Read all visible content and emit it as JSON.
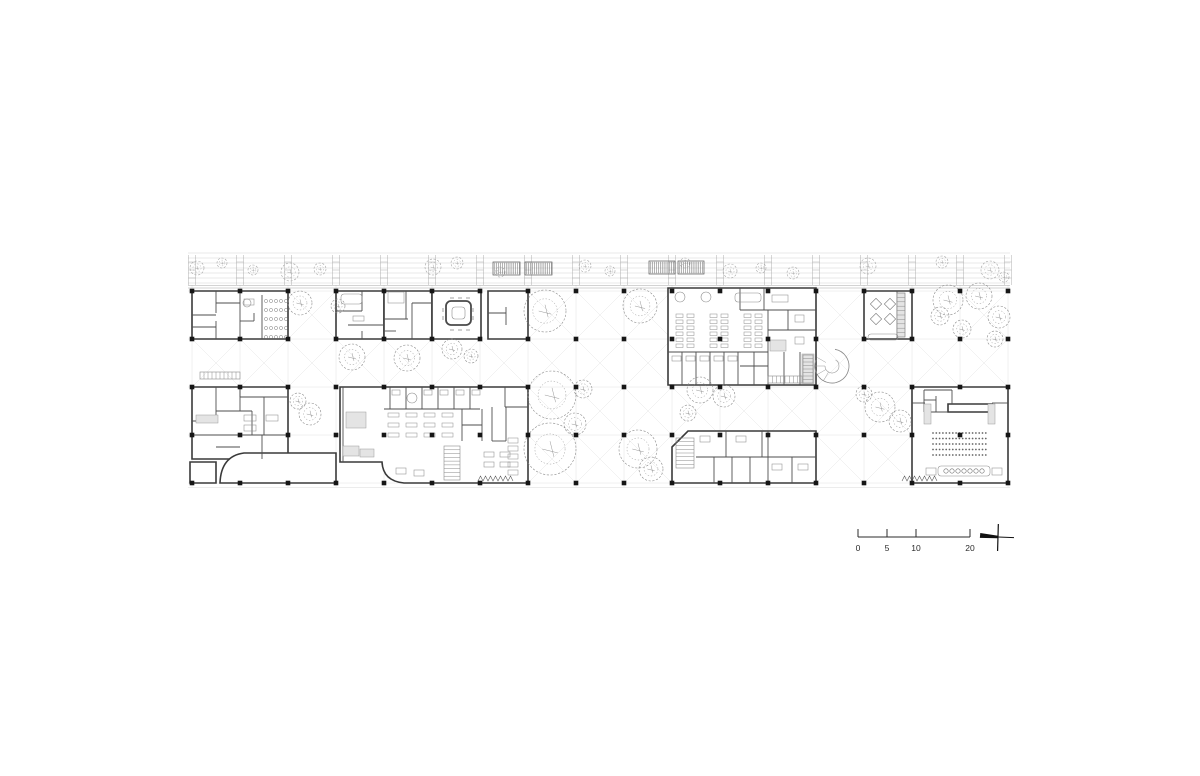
{
  "page": {
    "background": "#ffffff",
    "width": 1200,
    "height": 776,
    "title": "ground floor plan"
  },
  "colors": {
    "wall": "#3a3a3a",
    "partition": "#4e4e4e",
    "faint": "#cfcfcf",
    "band": "#b0b0b0",
    "bandEdge": "#8f8f8f",
    "furniture": "#8d8d8d",
    "tree": "#8a8a8a",
    "dot": "#161616",
    "gray": "#e4e4e4",
    "grayStroke": "#9a9a9a",
    "hatch": "#5a5a5a",
    "text": "#2b2b2b"
  },
  "grid": {
    "xs": [
      192,
      240,
      288,
      336,
      384,
      432,
      480,
      528,
      576,
      624,
      672,
      720,
      768,
      816,
      864,
      912,
      960,
      1008
    ],
    "ys": [
      291,
      339,
      387,
      435,
      483
    ],
    "y_top": 285,
    "y_bot": 487,
    "x_left": 188,
    "x_right": 1010,
    "dot_size": 4.6
  },
  "x_bays": [
    [
      2,
      0
    ],
    [
      7,
      0
    ],
    [
      8,
      0
    ],
    [
      9,
      0
    ],
    [
      13,
      0
    ],
    [
      16,
      0
    ],
    [
      0,
      1
    ],
    [
      1,
      1
    ],
    [
      2,
      1
    ],
    [
      3,
      1
    ],
    [
      4,
      1
    ],
    [
      5,
      1
    ],
    [
      6,
      1
    ],
    [
      7,
      1
    ],
    [
      8,
      1
    ],
    [
      9,
      1
    ],
    [
      13,
      1
    ],
    [
      14,
      1
    ],
    [
      15,
      1
    ],
    [
      16,
      1
    ],
    [
      7,
      2
    ],
    [
      8,
      2
    ],
    [
      9,
      2
    ],
    [
      10,
      2
    ],
    [
      11,
      2
    ],
    [
      12,
      2
    ],
    [
      13,
      2
    ],
    [
      14,
      2
    ],
    [
      7,
      3
    ],
    [
      8,
      3
    ],
    [
      9,
      3
    ],
    [
      13,
      3
    ],
    [
      14,
      3
    ]
  ],
  "top_band": {
    "lines_y": [
      253,
      258,
      263,
      268,
      273,
      278,
      283
    ],
    "edge_y": [
      285.5,
      288
    ],
    "bottom_faint_y": 487.5,
    "ladder_y0": 255,
    "ladder_y1": 285,
    "rung_y": [
      262,
      270,
      278
    ],
    "panels": [
      [
        493,
        262,
        27,
        13
      ],
      [
        525,
        262,
        27,
        13
      ],
      [
        649,
        261,
        26,
        13
      ],
      [
        678,
        261,
        26,
        13
      ]
    ],
    "trees": [
      [
        197,
        268,
        7
      ],
      [
        222,
        263,
        5
      ],
      [
        253,
        270,
        5
      ],
      [
        290,
        272,
        9
      ],
      [
        320,
        269,
        6
      ],
      [
        433,
        267,
        8
      ],
      [
        457,
        263,
        6
      ],
      [
        500,
        272,
        5
      ],
      [
        585,
        266,
        6
      ],
      [
        610,
        271,
        5
      ],
      [
        685,
        263,
        5
      ],
      [
        730,
        271,
        7
      ],
      [
        761,
        268,
        5
      ],
      [
        793,
        273,
        6
      ],
      [
        868,
        266,
        8
      ],
      [
        942,
        262,
        6
      ],
      [
        990,
        270,
        9
      ],
      [
        1004,
        277,
        5
      ]
    ]
  },
  "walls": [
    "M192,291 h96 v48 h-96 z",
    "M336,291 h48 v48 h-48 z",
    "M384,291 h48 v48 h-48 z",
    "M432,291 h49 v48 h-49 z",
    "M488,291 h40 v48 h-40 z",
    "M668,288 h148 v97 h-148 z",
    "M864,291 h48 v48 h-48 z",
    "M192,387 h96 v72 h-96 z",
    "M336,453 L244,453 Q221,456 220,483 L336,483 Z",
    "M190,462 h26 v21 h-26 z",
    "M340,387 L528,387 L528,483 L404,483 Q383,481 382,462 L340,462 Z",
    "M688,431 L816,431 L816,483 L672,483 L672,447 Z",
    "M912,387 h96 v96 h-96 z",
    "M948,404 h44 v8 h-44 z"
  ],
  "partitions": [
    [
      216,
      291,
      216,
      313
    ],
    [
      216,
      321,
      216,
      339
    ],
    [
      192,
      315,
      216,
      315
    ],
    [
      240,
      291,
      240,
      339
    ],
    [
      216,
      303,
      240,
      303
    ],
    [
      192,
      327,
      216,
      327
    ],
    [
      262,
      295,
      262,
      339
    ],
    [
      240,
      321,
      254,
      321
    ],
    [
      254,
      313,
      254,
      321
    ],
    [
      362,
      291,
      362,
      311
    ],
    [
      336,
      311,
      362,
      311
    ],
    [
      348,
      325,
      384,
      325
    ],
    [
      362,
      331,
      362,
      339
    ],
    [
      406,
      291,
      406,
      319
    ],
    [
      384,
      319,
      408,
      319
    ],
    [
      412,
      303,
      412,
      339
    ],
    [
      412,
      303,
      432,
      303
    ],
    [
      384,
      331,
      396,
      331
    ],
    [
      488,
      313,
      506,
      313
    ],
    [
      506,
      307,
      506,
      325
    ],
    [
      740,
      288,
      740,
      310
    ],
    [
      764,
      288,
      764,
      310
    ],
    [
      740,
      310,
      816,
      310
    ],
    [
      768,
      310,
      768,
      352
    ],
    [
      768,
      330,
      816,
      330
    ],
    [
      788,
      310,
      788,
      330
    ],
    [
      668,
      352,
      768,
      352
    ],
    [
      682,
      352,
      682,
      385
    ],
    [
      696,
      352,
      696,
      385
    ],
    [
      710,
      352,
      710,
      385
    ],
    [
      724,
      352,
      724,
      385
    ],
    [
      738,
      352,
      738,
      385
    ],
    [
      754,
      352,
      754,
      385
    ],
    [
      768,
      352,
      768,
      385
    ],
    [
      740,
      366,
      768,
      366
    ],
    [
      784,
      352,
      784,
      385
    ],
    [
      800,
      352,
      800,
      385
    ],
    [
      897,
      291,
      897,
      339
    ],
    [
      216,
      387,
      216,
      421
    ],
    [
      192,
      421,
      216,
      421
    ],
    [
      240,
      387,
      240,
      411
    ],
    [
      216,
      411,
      252,
      411
    ],
    [
      252,
      411,
      252,
      435
    ],
    [
      192,
      435,
      288,
      435
    ],
    [
      264,
      397,
      264,
      435
    ],
    [
      240,
      397,
      288,
      397
    ],
    [
      262,
      435,
      262,
      459
    ],
    [
      216,
      447,
      240,
      447
    ],
    [
      240,
      387,
      240,
      397
    ],
    [
      390,
      387,
      390,
      409
    ],
    [
      406,
      387,
      406,
      409
    ],
    [
      422,
      387,
      422,
      409
    ],
    [
      438,
      387,
      438,
      409
    ],
    [
      454,
      387,
      454,
      409
    ],
    [
      470,
      387,
      470,
      409
    ],
    [
      384,
      409,
      480,
      409
    ],
    [
      462,
      409,
      462,
      441
    ],
    [
      482,
      409,
      482,
      441
    ],
    [
      462,
      425,
      482,
      425
    ],
    [
      492,
      407,
      492,
      441
    ],
    [
      506,
      407,
      506,
      441
    ],
    [
      492,
      441,
      506,
      441
    ],
    [
      505,
      387,
      505,
      407
    ],
    [
      505,
      407,
      528,
      407
    ],
    [
      343,
      387,
      343,
      462
    ],
    [
      696,
      457,
      816,
      457
    ],
    [
      714,
      457,
      714,
      483
    ],
    [
      732,
      457,
      732,
      483
    ],
    [
      750,
      457,
      750,
      483
    ],
    [
      768,
      431,
      768,
      483
    ],
    [
      726,
      431,
      726,
      457
    ],
    [
      762,
      431,
      762,
      457
    ],
    [
      792,
      457,
      792,
      483
    ],
    [
      912,
      403,
      925,
      403
    ],
    [
      924,
      390,
      924,
      412
    ],
    [
      924,
      390,
      952,
      390
    ],
    [
      936,
      396,
      936,
      412
    ],
    [
      924,
      400,
      936,
      400
    ],
    [
      952,
      390,
      952,
      404
    ],
    [
      992,
      403,
      1008,
      403
    ],
    [
      924,
      412,
      948,
      412
    ]
  ],
  "gray_fills": [
    [
      770,
      340,
      16,
      11
    ],
    [
      802,
      354,
      12,
      30
    ],
    [
      346,
      412,
      20,
      16
    ],
    [
      343,
      446,
      16,
      10
    ],
    [
      360,
      449,
      14,
      8
    ],
    [
      196,
      415,
      22,
      8
    ],
    [
      924,
      404,
      7,
      20
    ],
    [
      988,
      404,
      7,
      20
    ],
    [
      897,
      293,
      8,
      44
    ]
  ],
  "light_rects": [
    [
      244,
      299,
      10,
      6
    ],
    [
      341,
      294,
      21,
      10
    ],
    [
      353,
      316,
      11,
      5
    ],
    [
      388,
      292,
      16,
      11
    ],
    [
      735,
      293,
      26,
      9
    ],
    [
      772,
      295,
      16,
      7
    ],
    [
      795,
      315,
      9,
      7
    ],
    [
      795,
      337,
      9,
      7
    ],
    [
      672,
      356,
      9,
      5
    ],
    [
      686,
      356,
      9,
      5
    ],
    [
      700,
      356,
      9,
      5
    ],
    [
      714,
      356,
      9,
      5
    ],
    [
      728,
      356,
      9,
      5
    ],
    [
      392,
      390,
      8,
      5
    ],
    [
      424,
      390,
      8,
      5
    ],
    [
      440,
      390,
      8,
      5
    ],
    [
      456,
      390,
      8,
      5
    ],
    [
      472,
      390,
      8,
      5
    ],
    [
      396,
      468,
      10,
      6
    ],
    [
      414,
      470,
      10,
      6
    ],
    [
      484,
      452,
      10,
      5
    ],
    [
      500,
      452,
      10,
      5
    ],
    [
      484,
      462,
      10,
      5
    ],
    [
      500,
      462,
      10,
      5
    ],
    [
      244,
      415,
      12,
      6
    ],
    [
      266,
      415,
      12,
      6
    ],
    [
      244,
      425,
      12,
      6
    ],
    [
      700,
      436,
      10,
      6
    ],
    [
      736,
      436,
      10,
      6
    ],
    [
      772,
      464,
      10,
      6
    ],
    [
      798,
      464,
      10,
      6
    ],
    [
      938,
      466,
      52,
      10
    ],
    [
      926,
      468,
      10,
      7
    ],
    [
      992,
      468,
      10,
      7
    ],
    [
      868,
      334,
      30,
      6
    ]
  ],
  "desk_grids": [
    {
      "x": 676,
      "y": 314,
      "cols": 2,
      "rows": 6,
      "w": 7,
      "h": 3.5,
      "dx": 11,
      "dy": 6
    },
    {
      "x": 710,
      "y": 314,
      "cols": 2,
      "rows": 6,
      "w": 7,
      "h": 3.5,
      "dx": 11,
      "dy": 6
    },
    {
      "x": 744,
      "y": 314,
      "cols": 2,
      "rows": 6,
      "w": 7,
      "h": 3.5,
      "dx": 11,
      "dy": 6
    },
    {
      "x": 388,
      "y": 413,
      "cols": 4,
      "rows": 3,
      "w": 11,
      "h": 4,
      "dx": 18,
      "dy": 10
    },
    {
      "x": 508,
      "y": 438,
      "cols": 1,
      "rows": 5,
      "w": 10,
      "h": 5,
      "dx": 0,
      "dy": 8
    }
  ],
  "round_tables": [
    [
      680,
      297,
      5
    ],
    [
      706,
      297,
      5
    ],
    [
      412,
      398,
      5
    ],
    [
      247,
      303,
      4
    ]
  ],
  "diamonds": [
    [
      876,
      304,
      8
    ],
    [
      890,
      304,
      8
    ],
    [
      876,
      319,
      8
    ],
    [
      890,
      319,
      8
    ]
  ],
  "toilet_grid": {
    "x0": 266,
    "y0": 301,
    "dx": 5,
    "dy": 9,
    "cols": 5,
    "rows": 5,
    "r": 1.6
  },
  "feature": {
    "outer": [
      446,
      301,
      25,
      24,
      5
    ],
    "inner": [
      452,
      307,
      13,
      12,
      3
    ]
  },
  "ticks": [
    [
      450,
      298,
      454,
      298
    ],
    [
      458,
      298,
      462,
      298
    ],
    [
      466,
      298,
      470,
      298
    ],
    [
      450,
      330,
      454,
      330
    ],
    [
      458,
      330,
      462,
      330
    ],
    [
      466,
      330,
      470,
      330
    ],
    [
      443,
      308,
      443,
      312
    ],
    [
      443,
      316,
      443,
      320
    ],
    [
      473,
      308,
      473,
      312
    ],
    [
      473,
      316,
      473,
      320
    ]
  ],
  "stairs": [
    {
      "x": 444,
      "y": 446,
      "w": 16,
      "h": 34,
      "n": 8,
      "dir": "h"
    },
    {
      "x": 676,
      "y": 438,
      "w": 18,
      "h": 30,
      "n": 7,
      "dir": "h"
    },
    {
      "x": 200,
      "y": 372,
      "w": 40,
      "h": 7,
      "n": 9,
      "dir": "v"
    },
    {
      "x": 768,
      "y": 376,
      "w": 34,
      "h": 7,
      "n": 7,
      "dir": "v"
    },
    {
      "x": 803,
      "y": 355,
      "w": 10,
      "h": 28,
      "n": 7,
      "dir": "h"
    },
    {
      "x": 897,
      "y": 293,
      "w": 8,
      "h": 44,
      "n": 9,
      "dir": "h"
    }
  ],
  "zigzags": [
    {
      "x": 478,
      "y": 481,
      "n": 7,
      "step": 5,
      "h": 5
    },
    {
      "x": 902,
      "y": 481,
      "n": 7,
      "step": 5,
      "h": 5
    }
  ],
  "spiral": {
    "cx": 832,
    "cy": 366,
    "r": 17,
    "r2": 7
  },
  "auditorium_seats": {
    "x0": 933,
    "x1": 987,
    "dx": 3.3,
    "rows": [
      433,
      438.5,
      444,
      449.5,
      455
    ],
    "r": 0.9
  },
  "stage_circles": {
    "x0": 946,
    "dx": 6,
    "n": 7,
    "y": 471,
    "r": 2.2
  },
  "trees": [
    [
      300,
      303,
      12
    ],
    [
      338,
      306,
      7
    ],
    [
      352,
      357,
      13
    ],
    [
      407,
      358,
      13
    ],
    [
      452,
      349,
      10
    ],
    [
      471,
      356,
      7
    ],
    [
      545,
      311,
      21
    ],
    [
      640,
      306,
      17
    ],
    [
      583,
      389,
      9
    ],
    [
      552,
      395,
      24
    ],
    [
      575,
      424,
      11
    ],
    [
      550,
      449,
      26
    ],
    [
      638,
      449,
      19
    ],
    [
      651,
      469,
      12
    ],
    [
      700,
      390,
      13
    ],
    [
      724,
      396,
      11
    ],
    [
      688,
      413,
      8
    ],
    [
      880,
      407,
      15
    ],
    [
      900,
      421,
      11
    ],
    [
      864,
      394,
      8
    ],
    [
      948,
      300,
      15
    ],
    [
      979,
      296,
      13
    ],
    [
      999,
      317,
      11
    ],
    [
      962,
      329,
      9
    ],
    [
      940,
      316,
      9
    ],
    [
      995,
      339,
      8
    ],
    [
      310,
      414,
      11
    ],
    [
      298,
      401,
      8
    ]
  ],
  "scale_bar": {
    "y": 537,
    "x0": 858,
    "x1": 970,
    "tick_top": 529,
    "label_y": 551,
    "ticks": [
      {
        "label": "0",
        "px": 858
      },
      {
        "label": "5",
        "px": 887
      },
      {
        "label": "10",
        "px": 916
      },
      {
        "label": "20",
        "px": 970
      }
    ]
  },
  "north_arrow": {
    "cx": 998,
    "cy": 537,
    "rot": 5
  }
}
